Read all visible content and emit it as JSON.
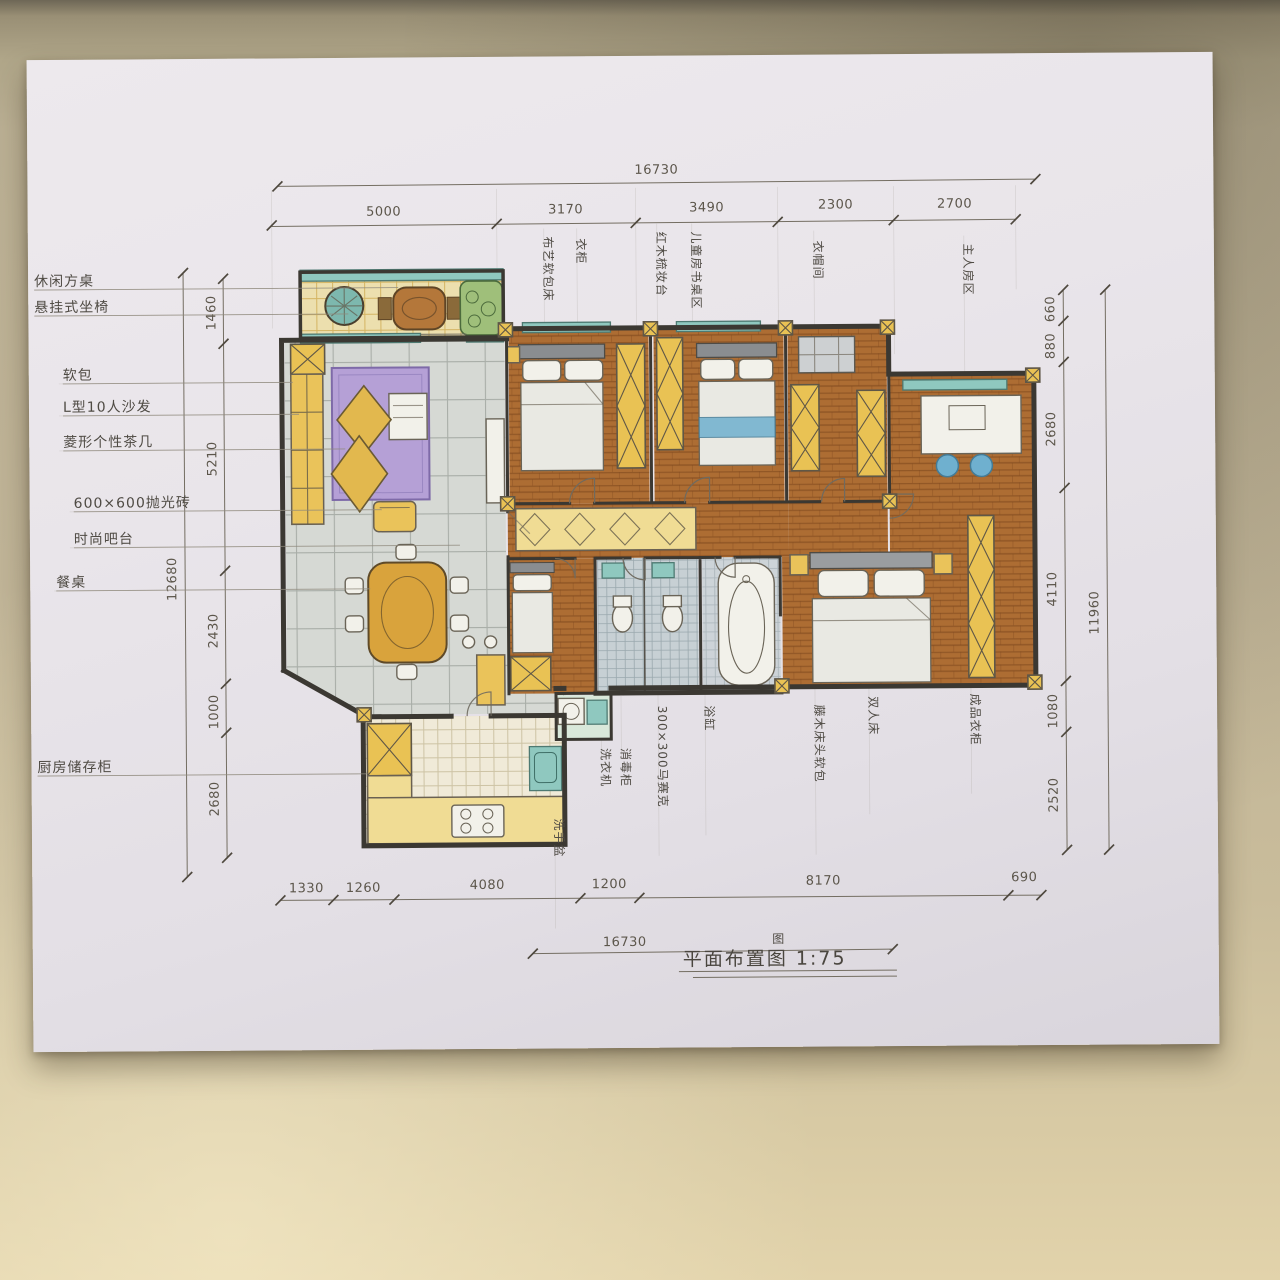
{
  "palette": {
    "table_top": "#b0a689",
    "table_bottom": "#e2d3ab",
    "paper": "#e9e5ea",
    "ink": "#3b3832",
    "pencil": "#8f8a7d",
    "wood_floor": "#ad6d33",
    "tile_gray": "#d6d9d4",
    "kitchen_tile": "#f0ead8",
    "mosaic": "#c7d0d4",
    "rug_purple": "#b5a0d6",
    "furniture_yellow": "#e9c254",
    "window_teal": "#8fc8bf",
    "chair_blue": "#6fb0cf"
  },
  "dims": {
    "top_total": "16730",
    "top_segments": [
      "5000",
      "3170",
      "3490",
      "2300",
      "2700"
    ],
    "left_total": "12680",
    "left_segments": [
      "1460",
      "5210",
      "2430",
      "1000",
      "2680"
    ],
    "right_total": "11960",
    "right_segments": [
      "660",
      "880",
      "2680",
      "4110",
      "1080",
      "2520"
    ],
    "bottom_segments": [
      "1330",
      "1260",
      "4080",
      "1200",
      "8170",
      "690"
    ],
    "bottom_total": "16730"
  },
  "labels": {
    "left": [
      "休闲方桌",
      "悬挂式坐椅",
      "软包",
      "L型10人沙发",
      "菱形个性茶几",
      "600×600抛光砖",
      "时尚吧台",
      "餐桌",
      "厨房储存柜"
    ],
    "top": [
      "布艺软包床",
      "衣柜",
      "红木梳妆台",
      "儿童房书桌区",
      "衣帽间",
      "主人房区"
    ],
    "mid": [
      "洗衣机",
      "消毒柜",
      "300×300马赛克",
      "浴缸",
      "藤木床头软包",
      "双人床",
      "成品衣柜",
      "洗手盆"
    ]
  },
  "title": {
    "text": "平面布置图 1:75",
    "correction": "图"
  }
}
